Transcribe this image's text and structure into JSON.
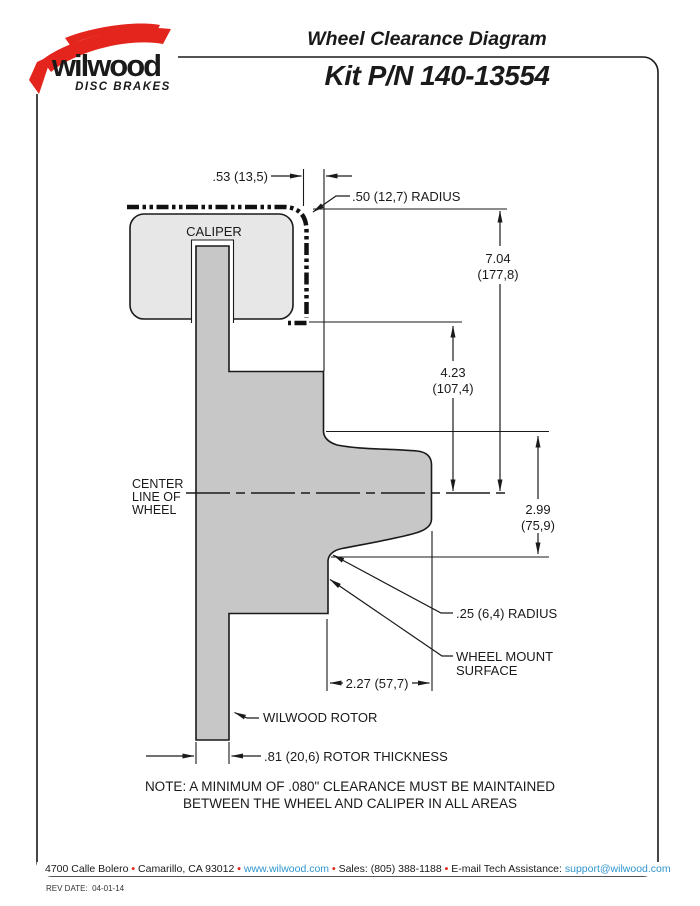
{
  "logo": {
    "brand": "wilwood",
    "tagline": "DISC BRAKES"
  },
  "header": {
    "title": "Wheel Clearance Diagram",
    "kit": "Kit P/N 140-13554"
  },
  "diagram": {
    "caliper_label": "CALIPER",
    "centerline": [
      "CENTER",
      "LINE OF",
      "WHEEL"
    ],
    "dims": {
      "offset": ".53 (13,5)",
      "outer_radius": ".50 (12,7) RADIUS",
      "height_total": "7.04",
      "height_total_mm": "(177,8)",
      "height_inner": "4.23",
      "height_inner_mm": "(107,4)",
      "hub_height": "2.99",
      "hub_height_mm": "(75,9)",
      "mount_depth": "2.27 (57,7)",
      "inner_radius": ".25 (6,4) RADIUS",
      "mount_surface_1": "WHEEL MOUNT",
      "mount_surface_2": "SURFACE",
      "rotor_label": "WILWOOD ROTOR",
      "rotor_thickness": ".81 (20,6) ROTOR THICKNESS"
    }
  },
  "note": {
    "line1": "NOTE: A MINIMUM OF .080\" CLEARANCE MUST BE MAINTAINED",
    "line2": "BETWEEN THE WHEEL AND CALIPER IN ALL AREAS"
  },
  "footer": {
    "address": "4700 Calle Bolero",
    "city": "Camarillo, CA 93012",
    "web": "www.wilwood.com",
    "sales": "Sales: (805) 388-1188",
    "email_label": "E-mail Tech Assistance:",
    "email": "support@wilwood.com",
    "bullet": "•",
    "rev": "REV DATE:  04-01-14"
  },
  "colors": {
    "red": "#e3251d",
    "link_blue": "#3095cc",
    "caliper_gray": "#e7e7e7",
    "rotor_gray": "#c7c7c7",
    "line_black": "#1a1a1a"
  }
}
